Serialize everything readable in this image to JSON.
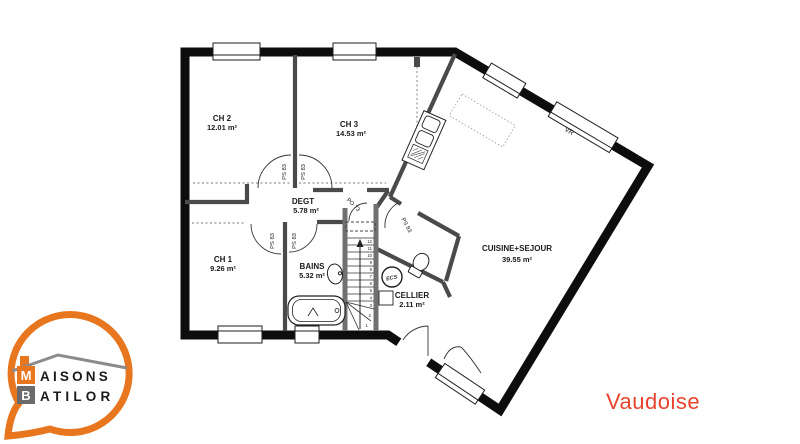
{
  "plan_name": {
    "text": "Vaudoise",
    "color": "#E8432D"
  },
  "logo": {
    "line1_initial": "M",
    "line1_rest": "AISONS",
    "line2_initial": "B",
    "line2_rest": "ATILOR",
    "orange": "#E8761F",
    "gray": "#6B6B6E"
  },
  "rooms": [
    {
      "id": "ch2",
      "name": "CH 2",
      "area": "12.01 m²"
    },
    {
      "id": "ch3",
      "name": "CH 3",
      "area": "14.53 m²"
    },
    {
      "id": "degt",
      "name": "DEGT",
      "area": "5.78 m²"
    },
    {
      "id": "ch1",
      "name": "CH 1",
      "area": "9.26 m²"
    },
    {
      "id": "bains",
      "name": "BAINS",
      "area": "5.32 m²"
    },
    {
      "id": "cellier",
      "name": "CELLIER",
      "area": "2.11 m²"
    },
    {
      "id": "cuisine",
      "name": "CUISINE+SEJOUR",
      "area": "39.55 m²"
    }
  ],
  "labels": {
    "door_ps83": "PS 83",
    "door_po73": "PO 73",
    "window_vr": "VR",
    "water_heater_ecs": "ECS"
  },
  "stairs": {
    "numbers": [
      "1",
      "2",
      "3",
      "4",
      "5",
      "6",
      "7",
      "8",
      "9",
      "10",
      "11",
      "12"
    ]
  }
}
